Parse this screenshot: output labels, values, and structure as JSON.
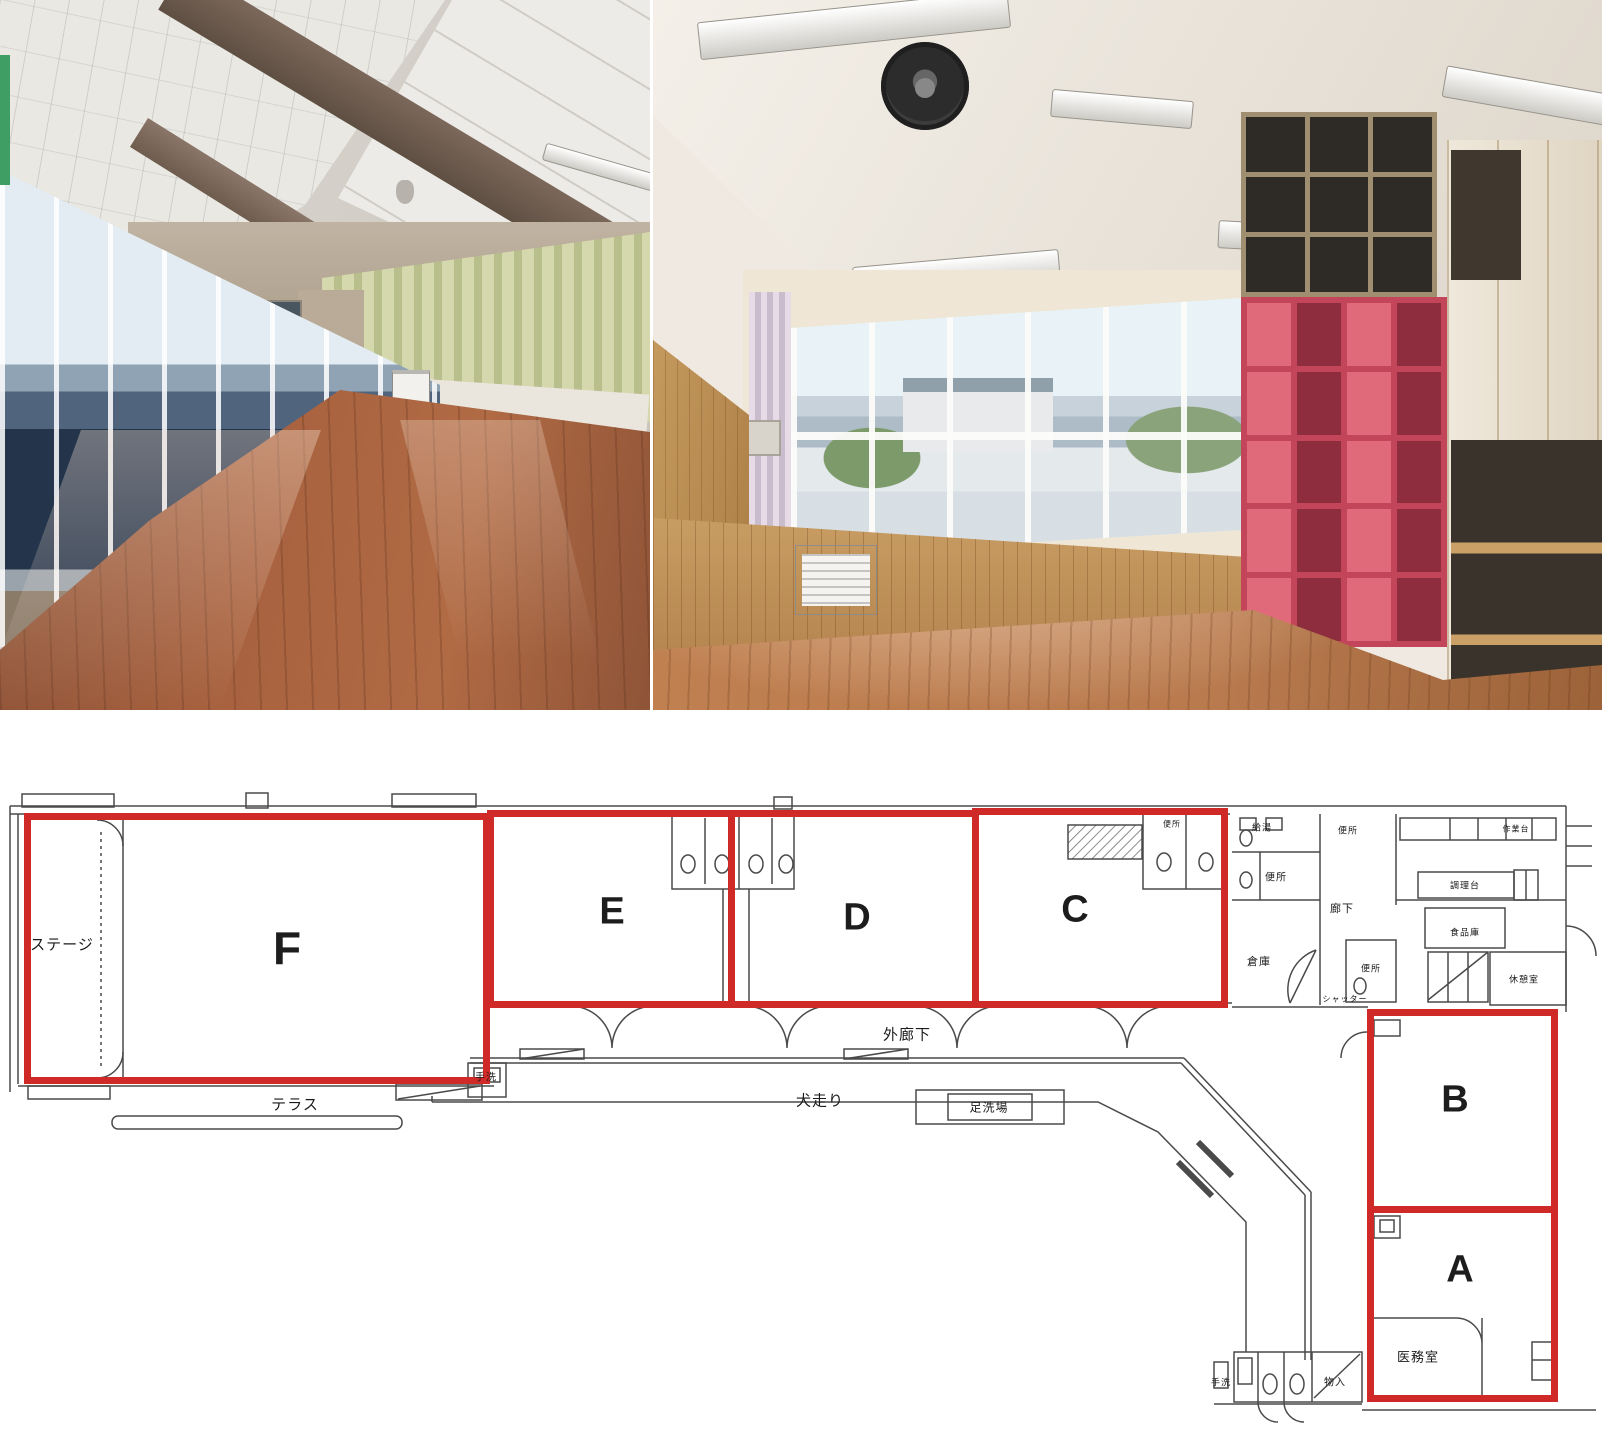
{
  "photos": {
    "left": {
      "name": "hall-interior-with-stage",
      "floor_color": "#9c5b3e",
      "curtain_color": "#ccd1a2",
      "stage_color": "#3c4a55"
    },
    "right": {
      "name": "classroom-interior-with-shelves",
      "floor_color": "#b97a4e",
      "shelf_color": "#c2455a",
      "wood_color": "#c08b52"
    }
  },
  "floor_plan": {
    "accent_red": "#cf2a28",
    "rooms": [
      {
        "id": "F",
        "label": "F",
        "x": 24,
        "y": 813,
        "w": 466,
        "h": 271,
        "label_x": 287,
        "label_y": 948,
        "label_size": 46
      },
      {
        "id": "E",
        "label": "E",
        "x": 487,
        "y": 810,
        "w": 248,
        "h": 198,
        "label_x": 612,
        "label_y": 912,
        "label_size": 38
      },
      {
        "id": "D",
        "label": "D",
        "x": 728,
        "y": 810,
        "w": 251,
        "h": 198,
        "label_x": 857,
        "label_y": 918,
        "label_size": 38
      },
      {
        "id": "C",
        "label": "C",
        "x": 972,
        "y": 808,
        "w": 256,
        "h": 200,
        "label_x": 1075,
        "label_y": 910,
        "label_size": 38
      },
      {
        "id": "B",
        "label": "B",
        "x": 1367,
        "y": 1009,
        "w": 191,
        "h": 204,
        "label_x": 1455,
        "label_y": 1100,
        "label_size": 38
      },
      {
        "id": "A",
        "label": "A",
        "x": 1367,
        "y": 1206,
        "w": 191,
        "h": 196,
        "label_x": 1460,
        "label_y": 1270,
        "label_size": 38
      }
    ],
    "annotations": [
      {
        "text": "ステージ",
        "x": 62,
        "y": 944,
        "size": 15
      },
      {
        "text": "テラス",
        "x": 295,
        "y": 1104,
        "size": 15
      },
      {
        "text": "手洗",
        "x": 486,
        "y": 1076,
        "size": 10
      },
      {
        "text": "外廊下",
        "x": 907,
        "y": 1034,
        "size": 15
      },
      {
        "text": "犬走り",
        "x": 820,
        "y": 1100,
        "size": 15
      },
      {
        "text": "足洗場",
        "x": 989,
        "y": 1107,
        "size": 12
      },
      {
        "text": "便所",
        "x": 1172,
        "y": 824,
        "size": 8
      },
      {
        "text": "給湯",
        "x": 1262,
        "y": 827,
        "size": 9
      },
      {
        "text": "便所",
        "x": 1276,
        "y": 876,
        "size": 10
      },
      {
        "text": "便所",
        "x": 1348,
        "y": 830,
        "size": 9
      },
      {
        "text": "廊下",
        "x": 1342,
        "y": 908,
        "size": 11
      },
      {
        "text": "倉庫",
        "x": 1259,
        "y": 961,
        "size": 11
      },
      {
        "text": "シャッター",
        "x": 1345,
        "y": 999,
        "size": 8
      },
      {
        "text": "便所",
        "x": 1371,
        "y": 968,
        "size": 9
      },
      {
        "text": "調理台",
        "x": 1465,
        "y": 885,
        "size": 9
      },
      {
        "text": "作業台",
        "x": 1516,
        "y": 829,
        "size": 8
      },
      {
        "text": "食品庫",
        "x": 1465,
        "y": 932,
        "size": 9
      },
      {
        "text": "休憩室",
        "x": 1524,
        "y": 979,
        "size": 9
      },
      {
        "text": "医務室",
        "x": 1418,
        "y": 1356,
        "size": 13
      },
      {
        "text": "手洗",
        "x": 1221,
        "y": 1382,
        "size": 9
      },
      {
        "text": "物入",
        "x": 1335,
        "y": 1381,
        "size": 10
      }
    ]
  }
}
